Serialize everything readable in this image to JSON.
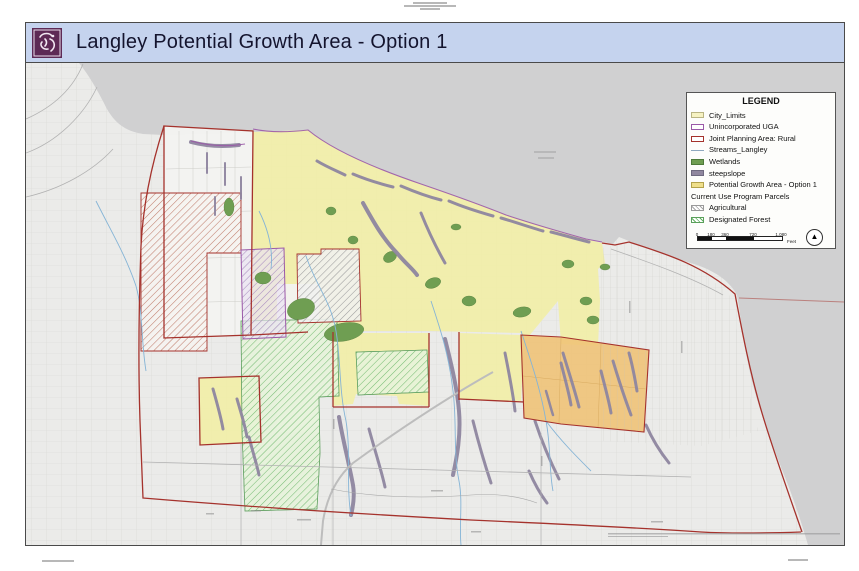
{
  "header": {
    "title": "Langley Potential Growth Area - Option 1",
    "logo": "langley-crest"
  },
  "legend": {
    "title": "LEGEND",
    "items": [
      {
        "label": "City_Limits",
        "swatch": "city-limits-outline"
      },
      {
        "label": "Unincorporated UGA",
        "swatch": "purple-outline"
      },
      {
        "label": "Joint Planning Area: Rural",
        "swatch": "red-outline"
      },
      {
        "label": "Streams_Langley",
        "swatch": "stream-line"
      },
      {
        "label": "Wetlands",
        "swatch": "green-fill"
      },
      {
        "label": "steepslope",
        "swatch": "gray-purple-fill"
      },
      {
        "label": "Potential Growth Area - Option 1",
        "swatch": "yellow-fill"
      },
      {
        "label": "Current Use Program Parcels",
        "swatch": "none"
      },
      {
        "label": "Agricultural",
        "swatch": "gray-hatch"
      },
      {
        "label": "Designated Forest",
        "swatch": "green-hatch"
      }
    ],
    "scalebar": {
      "ticks": [
        "0",
        "180",
        "360",
        "720",
        "1,080"
      ],
      "unit": "Feet"
    },
    "north_arrow_glyph": "▲"
  },
  "microtext": {
    "top_center": "(illegible fine print, 3 lines)",
    "bottom_left": "(illegible fine print)",
    "bottom_right": "(illegible fine print)",
    "map_disclaimer": "(illegible map source/disclaimer line)"
  },
  "colors": {
    "title_bar": "#c5d3ee",
    "logo_purple": "#5d2a55",
    "water": "#d0d0d1",
    "land": "#ebebe9",
    "growth_yellow": "#f2efa2",
    "orange_area": "#efc378",
    "wetland_green": "#6f9e52",
    "steepslope": "#8f86a0",
    "stream_blue": "#85b4d6",
    "jpa_red": "#a5322c",
    "uga_purple": "#9b59a8",
    "forest_hatch": "#5db05d"
  }
}
